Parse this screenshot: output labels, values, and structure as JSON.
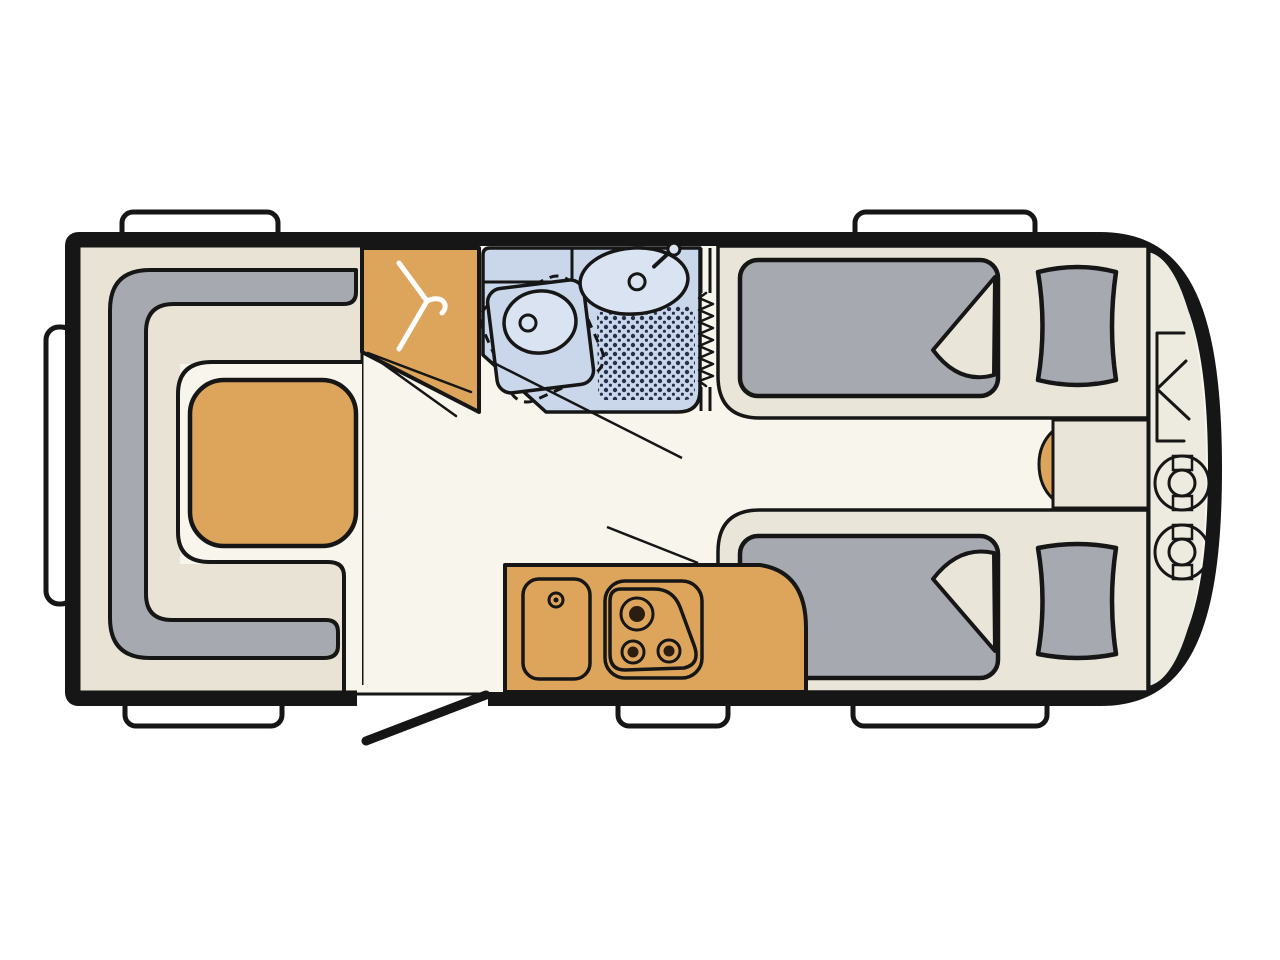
{
  "meta": {
    "title": "Caravan floor plan (top view)",
    "diagram_type": "vehicle-floorplan",
    "visible_text": "none"
  },
  "colors": {
    "background": "#ffffff",
    "ink": "#161616",
    "floor": "#f8f5ec",
    "bench_cream": "#e8e3d4",
    "bed_base": "#e9e5d8",
    "front_floor": "#edeadf",
    "upholstery_gray": "#a6a9af",
    "wood_orange": "#dda55c",
    "bath_blue": "#cad7eb",
    "fixture_blue": "#dae3f2",
    "shower_dot": "#24304c",
    "burner_dark": "#2b1d10",
    "trim_white": "#ffffff"
  },
  "vehicle": {
    "windows": 5,
    "rear_bumper_rails": 1,
    "entry_door": "open leaf, bottom wall between lounge and kitchen",
    "front_end": "rounded, with interior gas locker"
  },
  "rooms": {
    "lounge": {
      "name": "U-shaped lounge (rear)",
      "furniture": [
        "U-sofa with gray backrest",
        "cream seat cushions",
        "table"
      ]
    },
    "wardrobe": {
      "name": "Wardrobe",
      "icon": "clothes-hanger",
      "doors_shown_open": 2
    },
    "bathroom": {
      "name": "Washroom",
      "fixtures": [
        "swivel toilet (dashed alternate position)",
        "washbasin with tap",
        "shower tray"
      ],
      "door": "accordion / concertina door"
    },
    "kitchen": {
      "name": "Kitchen block",
      "fixtures": [
        "sink",
        "hob with 3 burners"
      ]
    },
    "bedroom": {
      "name": "Twin single beds (front)",
      "beds": 2,
      "pillows": 2,
      "mattress_corners_folded": 2,
      "between_beds": "bedside chest with cushion pad"
    },
    "front_locker": {
      "name": "Front gas locker",
      "gas_bottles": 2,
      "door_symbol": "double-wing locker door"
    }
  }
}
